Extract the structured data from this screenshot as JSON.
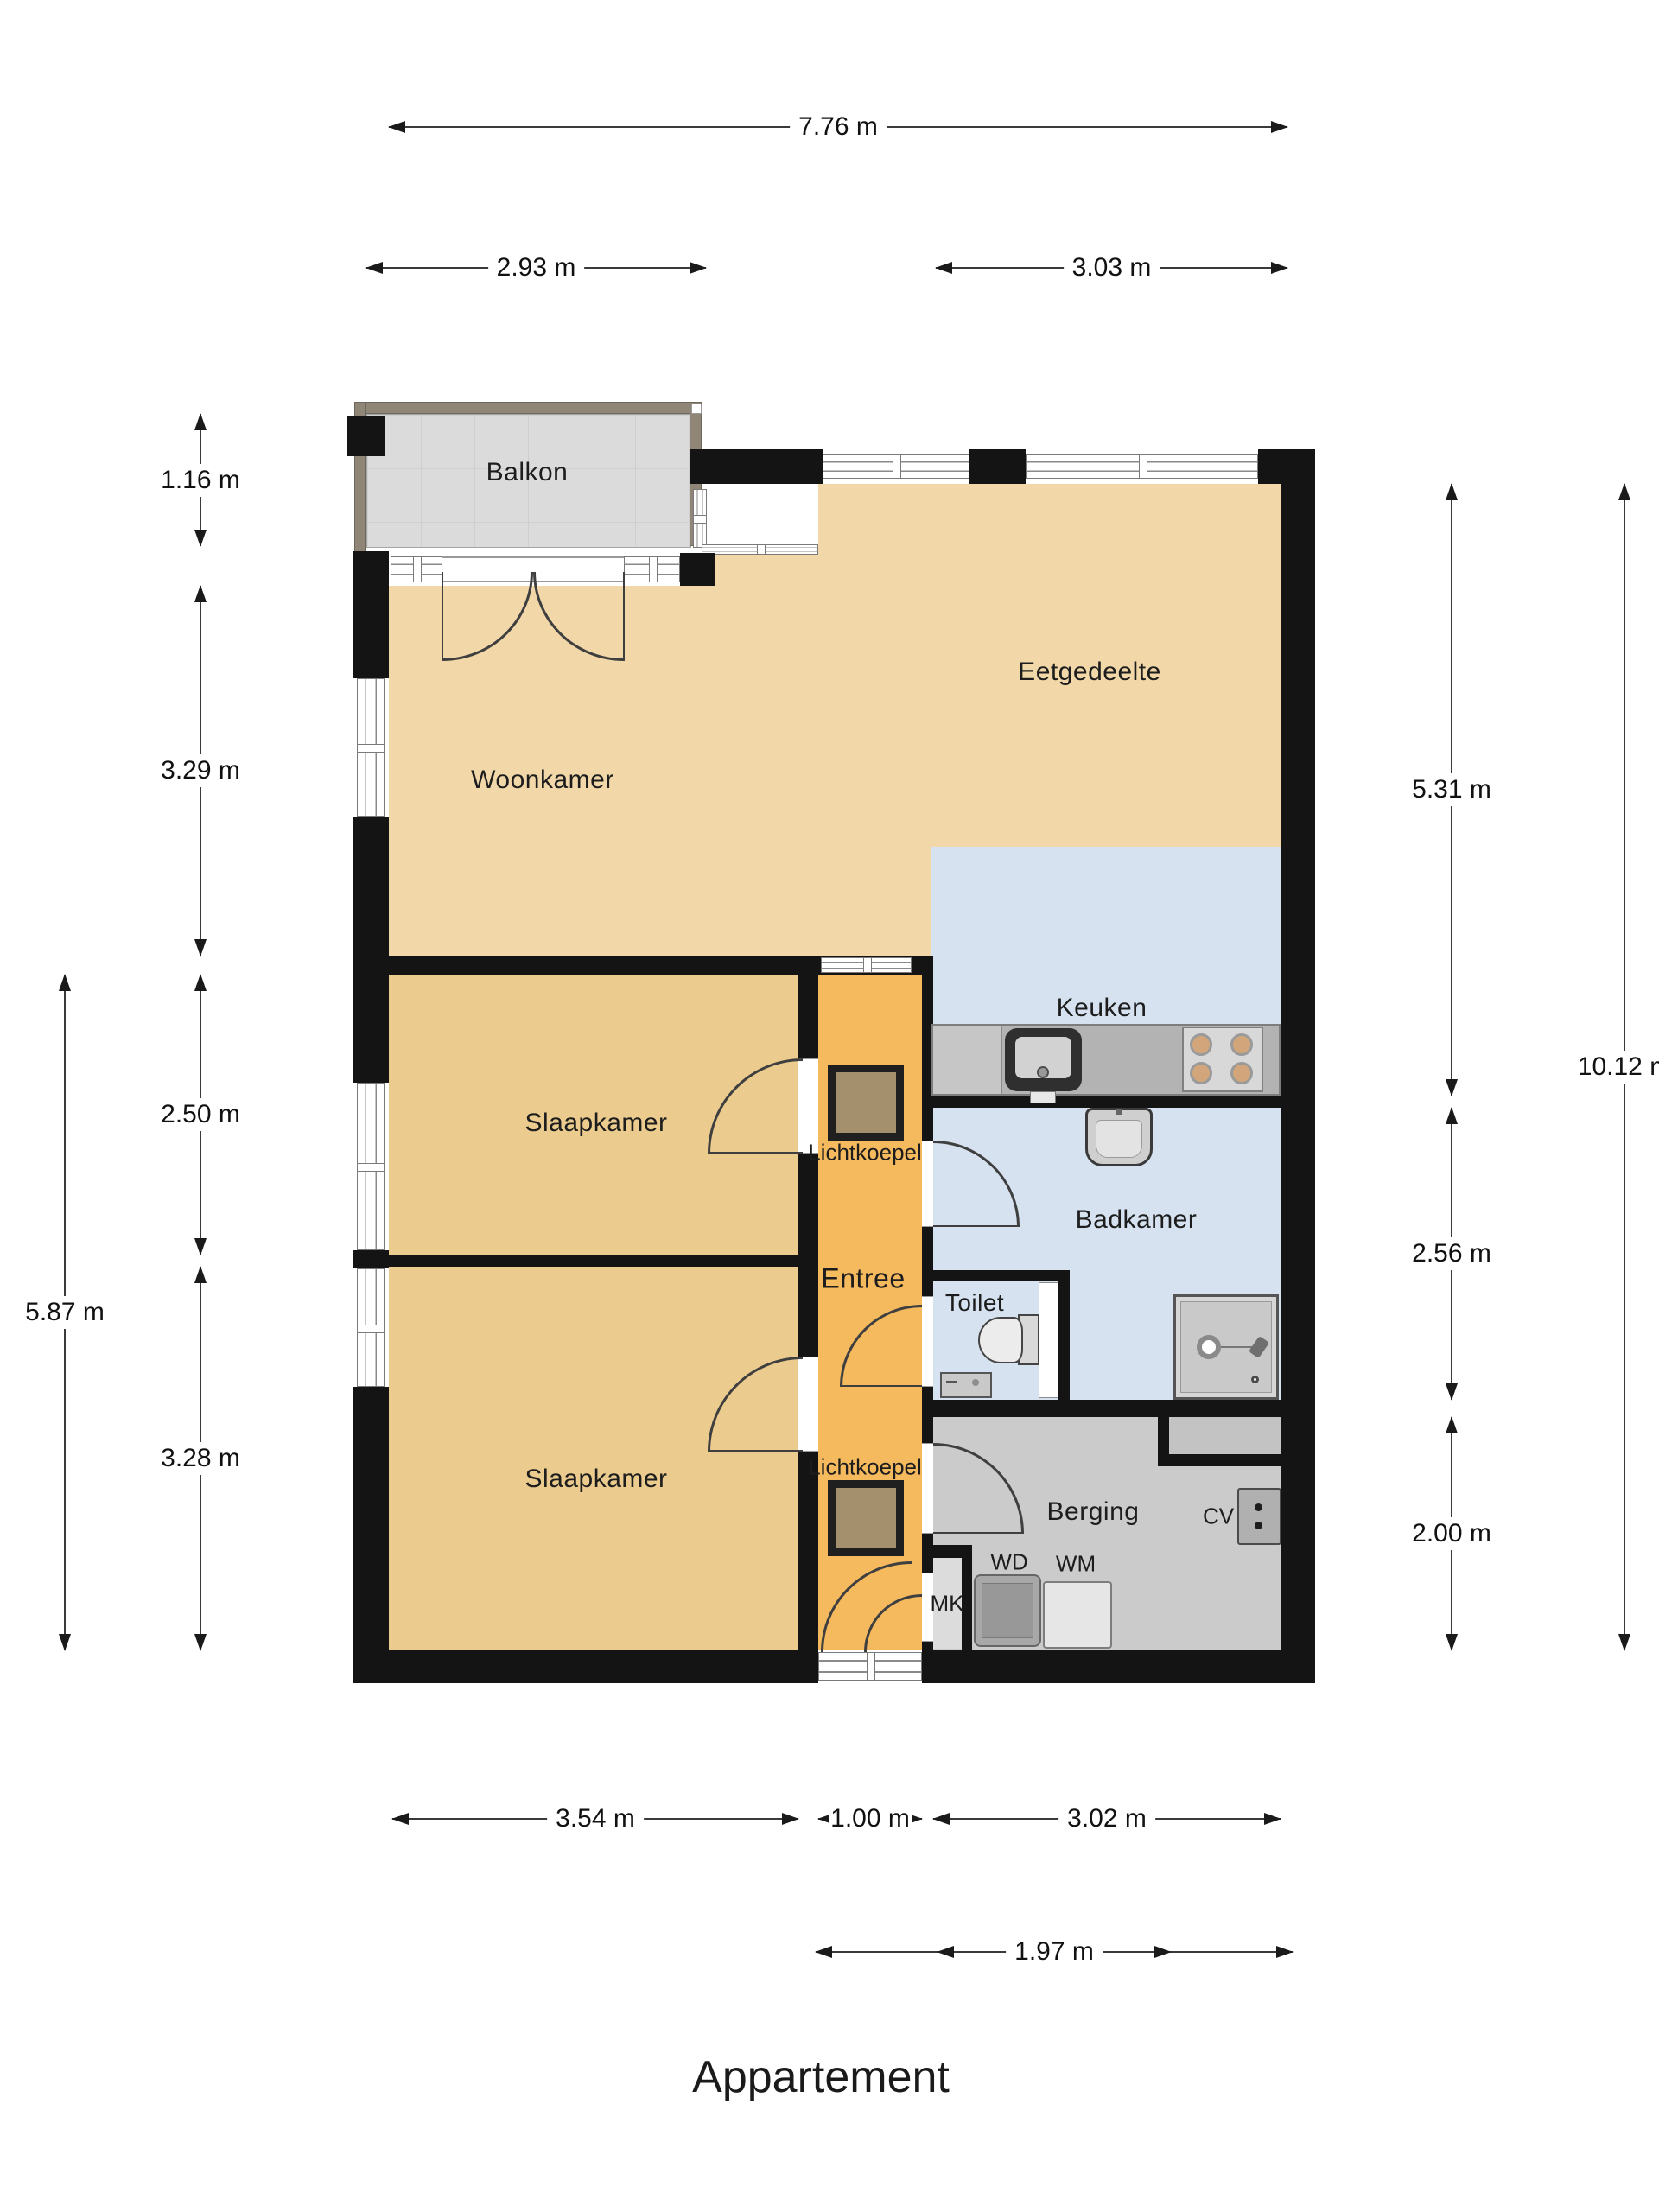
{
  "title": "Appartement",
  "rooms": {
    "balkon": "Balkon",
    "woonkamer": "Woonkamer",
    "eetgedeelte": "Eetgedeelte",
    "keuken": "Keuken",
    "slaapkamer1": "Slaapkamer",
    "slaapkamer2": "Slaapkamer",
    "entree": "Entree",
    "badkamer": "Badkamer",
    "toilet": "Toilet",
    "berging": "Berging",
    "lichtkoepel1": "Lichtkoepel",
    "lichtkoepel2": "Lichtkoepel"
  },
  "fixtures": {
    "mk": "MK",
    "wd": "WD",
    "wm": "WM",
    "cv": "CV"
  },
  "dimensions": {
    "top_total": "7.76 m",
    "top_left": "2.93 m",
    "top_right": "3.03 m",
    "left_balcony": "1.16 m",
    "left_living": "3.29 m",
    "left_bed1": "2.50 m",
    "left_bed2": "3.28 m",
    "left_total": "5.87 m",
    "right_upper": "5.31 m",
    "right_bath": "2.56 m",
    "right_storage": "2.00 m",
    "right_total": "10.12 m",
    "bottom_bed": "3.54 m",
    "bottom_hall": "1.00 m",
    "bottom_storage": "3.02 m",
    "bottom_inner": "1.97 m"
  },
  "colors": {
    "living": "#f2d8a9",
    "bedroom": "#eccc8e",
    "hall": "#f5b95e",
    "wet": "#d6e2f0",
    "storage": "#cbcbcb",
    "storage_light": "#dcdcdc",
    "niche": "#c3c3c3",
    "balcony": "#dbdbdb",
    "skylight": "#a5906d",
    "wall": "#141414",
    "counter": "#b3b3b3"
  }
}
